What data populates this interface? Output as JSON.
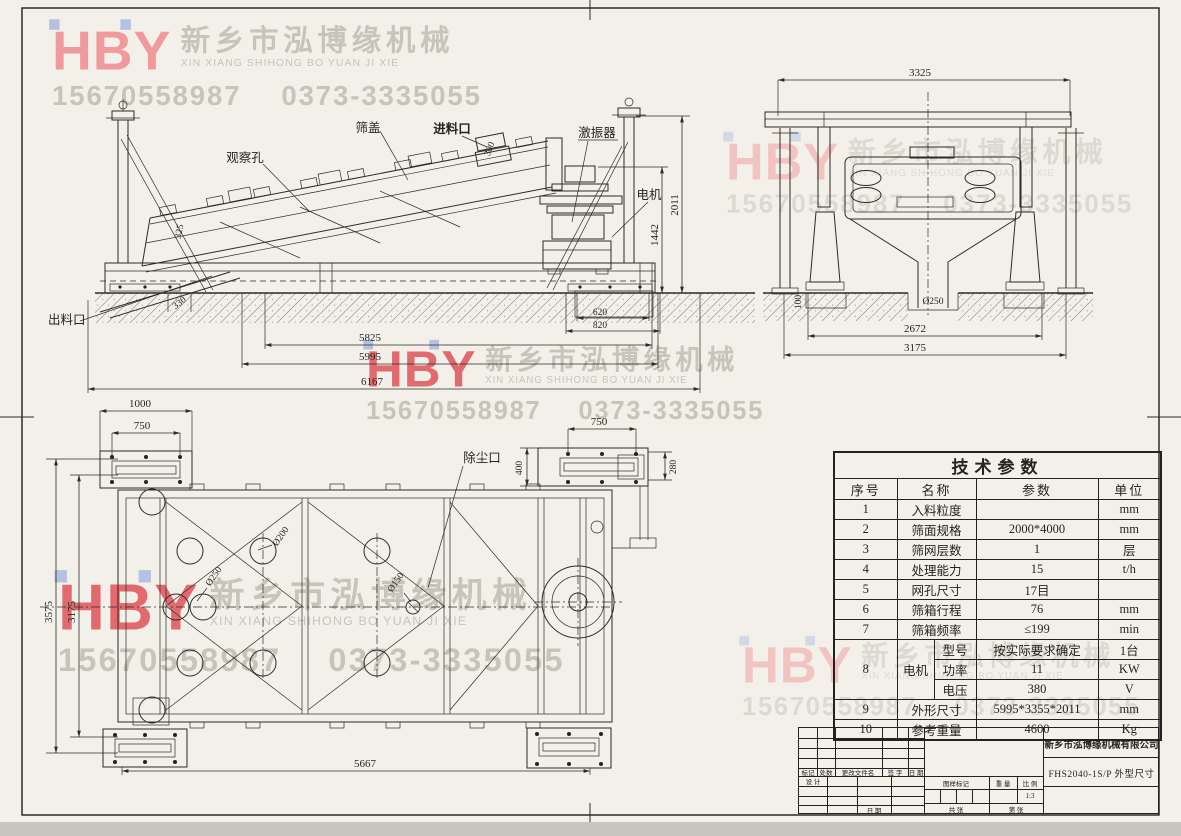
{
  "watermark": {
    "logo": "HBY",
    "company_cn": "新乡市泓博缘机械",
    "company_pinyin": "XIN XIANG SHIHONG BO YUAN JI XIE",
    "phone_mobile": "15670558987",
    "phone_tel": "0373-3335055",
    "logo_color": "#f19a9d",
    "logo_accent_color": "#b5c1e2",
    "text_color": "#c7c4ba"
  },
  "views": {
    "side": {
      "labels": {
        "observation_hole": "观察孔",
        "screen_cover": "筛盖",
        "feed_inlet": "进料口",
        "exciter": "激振器",
        "motor": "电机",
        "discharge_outlet": "出料口"
      },
      "dims": {
        "feed_width": "300",
        "incline": "325",
        "motor_height": "1442",
        "total_height": "2011",
        "discharge_offset": "330",
        "base_inner": "620",
        "base_outer": "820",
        "length_inner": "5825",
        "length_frame": "5995",
        "length_total": "6167"
      }
    },
    "end": {
      "dims": {
        "width_top": "3325",
        "chute_dia": "Ø250",
        "pit_depth": "100",
        "base_inner": "2672",
        "base_outer": "3175"
      }
    },
    "plan": {
      "labels": {
        "dust_port": "除尘口"
      },
      "dims": {
        "bracket_len": "1000",
        "bracket_bolt": "750",
        "dust_bolt": "750",
        "dust_width": "400",
        "dust_height": "280",
        "hole_large": "Ø250",
        "hole_mid": "Ø200",
        "hole_small": "Ø150",
        "width_total": "3575",
        "width_frame": "3175",
        "base_length": "5667"
      }
    }
  },
  "tech_table": {
    "title": "技术参数",
    "headers": {
      "no": "序号",
      "name": "名称",
      "value": "参数",
      "unit": "单位"
    },
    "r1": {
      "no": "1",
      "name": "入料粒度",
      "value": "",
      "unit": "mm"
    },
    "r2": {
      "no": "2",
      "name": "筛面规格",
      "value": "2000*4000",
      "unit": "mm"
    },
    "r3": {
      "no": "3",
      "name": "筛网层数",
      "value": "1",
      "unit": "层"
    },
    "r4": {
      "no": "4",
      "name": "处理能力",
      "value": "15",
      "unit": "t/h"
    },
    "r5": {
      "no": "5",
      "name": "网孔尺寸",
      "value": "17目",
      "unit": ""
    },
    "r6": {
      "no": "6",
      "name": "筛箱行程",
      "value": "76",
      "unit": "mm"
    },
    "r7": {
      "no": "7",
      "name": "筛箱频率",
      "value": "≤199",
      "unit": "min"
    },
    "r8": {
      "no": "8",
      "name": "电机",
      "sub1": {
        "name": "型号",
        "value": "按实际要求确定",
        "unit": "1台"
      },
      "sub2": {
        "name": "功率",
        "value": "11",
        "unit": "KW"
      },
      "sub3": {
        "name": "电压",
        "value": "380",
        "unit": "V"
      }
    },
    "r9": {
      "no": "9",
      "name": "外形尺寸",
      "value": "5995*3355*2011",
      "unit": "mm"
    },
    "r10": {
      "no": "10",
      "name": "参考重量",
      "value": "4600",
      "unit": "Kg"
    }
  },
  "title_block": {
    "company": "新乡市泓博缘机械有限公司",
    "drawing_title": "FHS2040-1S/P  外型尺寸",
    "labels": {
      "mark": "标记",
      "count": "处数",
      "changed_file": "更改文件名",
      "signature": "签 字",
      "date": "日 期",
      "design": "设 计",
      "date2": "日 期",
      "drawing_mark": "图样标记",
      "weight": "重 量",
      "scale": "比 例",
      "scale_value": "1:3",
      "sheets_total": "共  张",
      "sheet_no": "第  张"
    }
  }
}
